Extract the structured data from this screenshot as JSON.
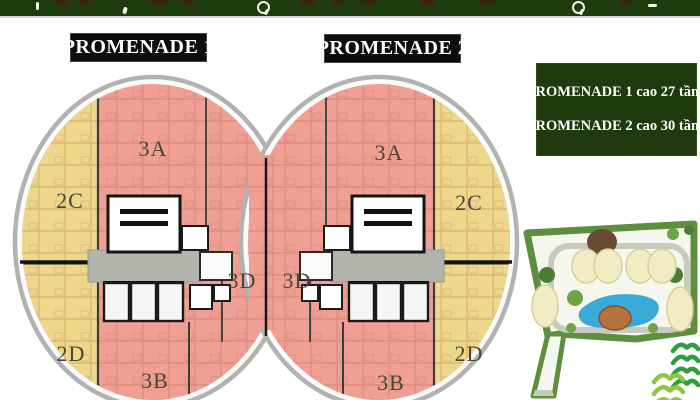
{
  "banner": {
    "color": "#1d3b0c"
  },
  "floor_plans": {
    "promenade1": {
      "title": "PROMENADE 1",
      "units": {
        "top": "3A",
        "side_upper": "2C",
        "side_lower": "2D",
        "bottom": "3B",
        "inner": "3D"
      }
    },
    "promenade2": {
      "title": "PROMENADE 2",
      "units": {
        "top": "3A",
        "side_upper": "2C",
        "side_lower": "2D",
        "bottom": "3B",
        "inner": "3D"
      }
    }
  },
  "info_panel": {
    "line1": "PROMENADE 1 cao 27 tầng",
    "line2": "PROMENADE 2 cao 30 tầng"
  },
  "colors": {
    "unit_pink": "#f0a093",
    "unit_yellow": "#ecd78b",
    "corridor_gray": "#b0b4aa",
    "ring_gray": "#b2b2b0",
    "panel_green": "#1d3b0c",
    "title_bg": "#0d0d0d",
    "pool_blue": "#39a9d8",
    "site_border_green": "#5d8f3f",
    "logo_green_dark": "#2f9e41",
    "logo_green_light": "#8dc63f"
  }
}
